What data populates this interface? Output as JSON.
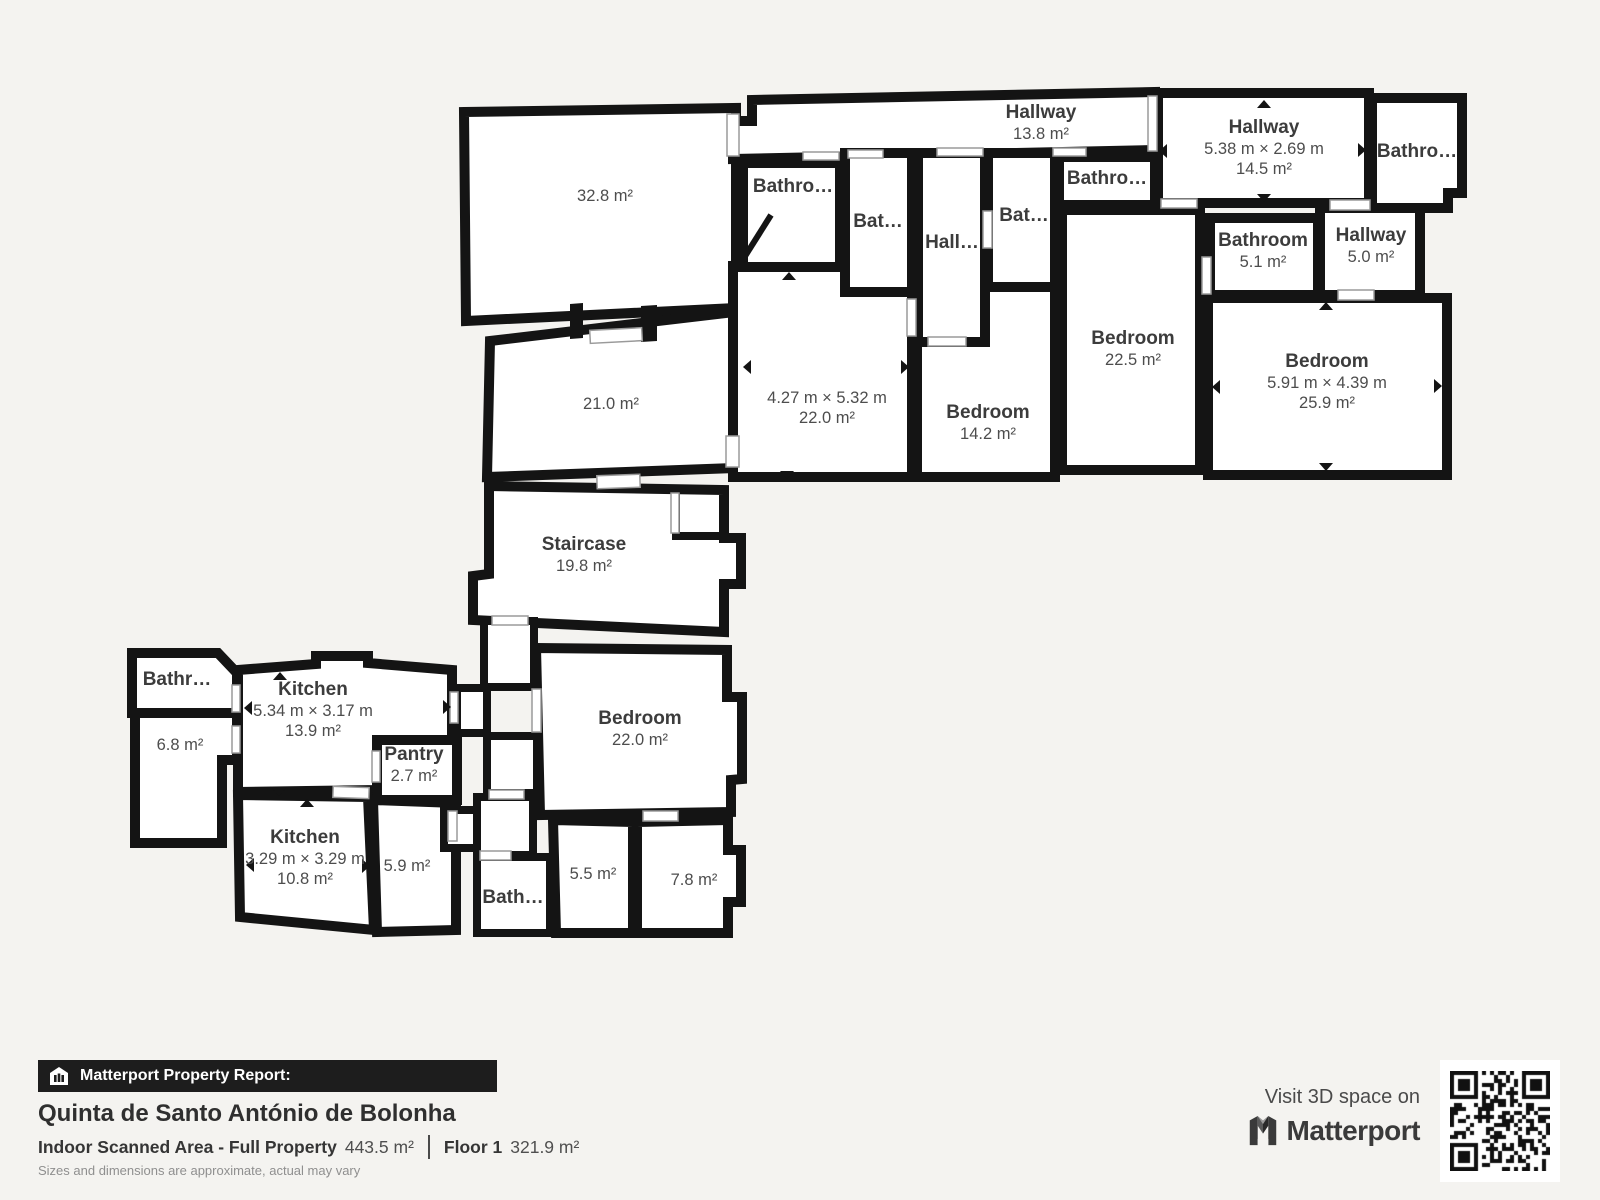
{
  "colors": {
    "background": "#f4f3f0",
    "wall": "#141414",
    "room_fill": "#ffffff",
    "label": "#3c3c3c",
    "bar_bg": "#1d1d1d"
  },
  "icons": {
    "report_bar": "house-icon",
    "brand": "matterport-logo-icon",
    "qr": "qr-code"
  },
  "floorplan": {
    "rooms": [
      {
        "id": "room-32-8",
        "area": "32.8 m²",
        "x": 605,
        "y": 196
      },
      {
        "id": "room-21-0",
        "area": "21.0 m²",
        "x": 611,
        "y": 404
      },
      {
        "id": "staircase",
        "name": "Staircase",
        "area": "19.8 m²",
        "x": 584,
        "y": 545
      },
      {
        "id": "hallway-13-8",
        "name": "Hallway",
        "area": "13.8 m²",
        "x": 1041,
        "y": 113
      },
      {
        "id": "hallway-14-5",
        "name": "Hallway",
        "dims": "5.38 m × 2.69 m",
        "area": "14.5 m²",
        "x": 1264,
        "y": 128
      },
      {
        "id": "bathroom-tr",
        "name": "Bathro…",
        "x": 1417,
        "y": 152
      },
      {
        "id": "bathroom-l1",
        "name": "Bathro…",
        "x": 793,
        "y": 187
      },
      {
        "id": "bathroom-l2",
        "name": "Bat…",
        "x": 878,
        "y": 222
      },
      {
        "id": "hall-center",
        "name": "Hall…",
        "x": 952,
        "y": 243
      },
      {
        "id": "bathroom-l3",
        "name": "Bat…",
        "x": 1024,
        "y": 216
      },
      {
        "id": "bathroom-mid",
        "name": "Bathro…",
        "x": 1107,
        "y": 179
      },
      {
        "id": "bedroom-center",
        "dims": "4.27 m × 5.32 m",
        "area": "22.0 m²",
        "x": 827,
        "y": 398
      },
      {
        "id": "bedroom-14-2",
        "name": "Bedroom",
        "area": "14.2 m²",
        "x": 988,
        "y": 413
      },
      {
        "id": "bedroom-22-5",
        "name": "Bedroom",
        "area": "22.5 m²",
        "x": 1133,
        "y": 339
      },
      {
        "id": "bathroom-5-1",
        "name": "Bathroom",
        "area": "5.1 m²",
        "x": 1263,
        "y": 241
      },
      {
        "id": "hallway-5-0",
        "name": "Hallway",
        "area": "5.0 m²",
        "x": 1371,
        "y": 236
      },
      {
        "id": "bedroom-25-9",
        "name": "Bedroom",
        "dims": "5.91 m × 4.39 m",
        "area": "25.9 m²",
        "x": 1327,
        "y": 362
      },
      {
        "id": "bathr-tl",
        "name": "Bathr…",
        "x": 177,
        "y": 680
      },
      {
        "id": "room-6-8",
        "area": "6.8 m²",
        "x": 180,
        "y": 745
      },
      {
        "id": "kitchen-13-9",
        "name": "Kitchen",
        "dims": "5.34 m × 3.17 m",
        "area": "13.9 m²",
        "x": 313,
        "y": 690
      },
      {
        "id": "pantry",
        "name": "Pantry",
        "area": "2.7 m²",
        "x": 414,
        "y": 755
      },
      {
        "id": "kitchen-10-8",
        "name": "Kitchen",
        "dims": "3.29 m × 3.29 m",
        "area": "10.8 m²",
        "x": 305,
        "y": 838
      },
      {
        "id": "room-5-9",
        "area": "5.9 m²",
        "x": 407,
        "y": 866
      },
      {
        "id": "bedroom-22-0",
        "name": "Bedroom",
        "area": "22.0 m²",
        "x": 640,
        "y": 719
      },
      {
        "id": "bath-bottom",
        "name": "Bath…",
        "x": 513,
        "y": 898
      },
      {
        "id": "room-5-5",
        "area": "5.5 m²",
        "x": 593,
        "y": 874
      },
      {
        "id": "room-7-8",
        "area": "7.8 m²",
        "x": 694,
        "y": 880
      }
    ],
    "doors": [
      [
        727,
        114,
        12,
        42,
        0
      ],
      [
        1148,
        96,
        9,
        55,
        0
      ],
      [
        803,
        152,
        36,
        8,
        0
      ],
      [
        848,
        150,
        35,
        8,
        0
      ],
      [
        937,
        148,
        46,
        8,
        0
      ],
      [
        1053,
        148,
        33,
        8,
        0
      ],
      [
        1161,
        199,
        36,
        9,
        0
      ],
      [
        1330,
        200,
        40,
        10,
        0
      ],
      [
        1338,
        290,
        36,
        10,
        0
      ],
      [
        1202,
        257,
        9,
        37,
        0
      ],
      [
        928,
        337,
        38,
        9,
        0
      ],
      [
        983,
        211,
        9,
        37,
        0
      ],
      [
        907,
        299,
        9,
        37,
        0
      ],
      [
        590,
        329,
        52,
        13,
        -3
      ],
      [
        726,
        436,
        13,
        31,
        0
      ],
      [
        597,
        475,
        43,
        13,
        -2
      ],
      [
        671,
        493,
        8,
        40,
        0
      ],
      [
        492,
        616,
        36,
        9,
        0
      ],
      [
        450,
        692,
        8,
        31,
        0
      ],
      [
        333,
        787,
        36,
        11,
        2
      ],
      [
        372,
        751,
        8,
        31,
        0
      ],
      [
        232,
        685,
        8,
        27,
        0
      ],
      [
        232,
        726,
        8,
        27,
        0
      ],
      [
        448,
        811,
        9,
        30,
        0
      ],
      [
        489,
        790,
        35,
        9,
        0
      ],
      [
        480,
        851,
        31,
        9,
        0
      ],
      [
        532,
        689,
        9,
        43,
        0
      ],
      [
        643,
        811,
        35,
        10,
        0
      ]
    ],
    "arrows": [
      [
        280,
        676,
        "up"
      ],
      [
        248,
        708,
        "left"
      ],
      [
        447,
        707,
        "right"
      ],
      [
        279,
        792,
        "down"
      ],
      [
        307,
        803,
        "up"
      ],
      [
        250,
        865,
        "left"
      ],
      [
        366,
        866,
        "right"
      ],
      [
        304,
        923,
        "down"
      ],
      [
        789,
        276,
        "up"
      ],
      [
        747,
        367,
        "left"
      ],
      [
        905,
        367,
        "right"
      ],
      [
        787,
        475,
        "down"
      ],
      [
        1264,
        104,
        "up"
      ],
      [
        1163,
        151,
        "left"
      ],
      [
        1362,
        150,
        "right"
      ],
      [
        1264,
        198,
        "down"
      ],
      [
        1326,
        306,
        "up"
      ],
      [
        1216,
        387,
        "left"
      ],
      [
        1438,
        386,
        "right"
      ],
      [
        1326,
        467,
        "down"
      ]
    ]
  },
  "footer": {
    "report_label": "Matterport Property Report:",
    "title": "Quinta de Santo António de Bolonha",
    "scan_label": "Indoor Scanned Area - Full Property",
    "scan_value": "443.5 m²",
    "floor_label": "Floor 1",
    "floor_value": "321.9 m²",
    "disclaimer": "Sizes and dimensions are approximate, actual may vary"
  },
  "visit": {
    "line1": "Visit 3D space on",
    "brand": "Matterport"
  }
}
